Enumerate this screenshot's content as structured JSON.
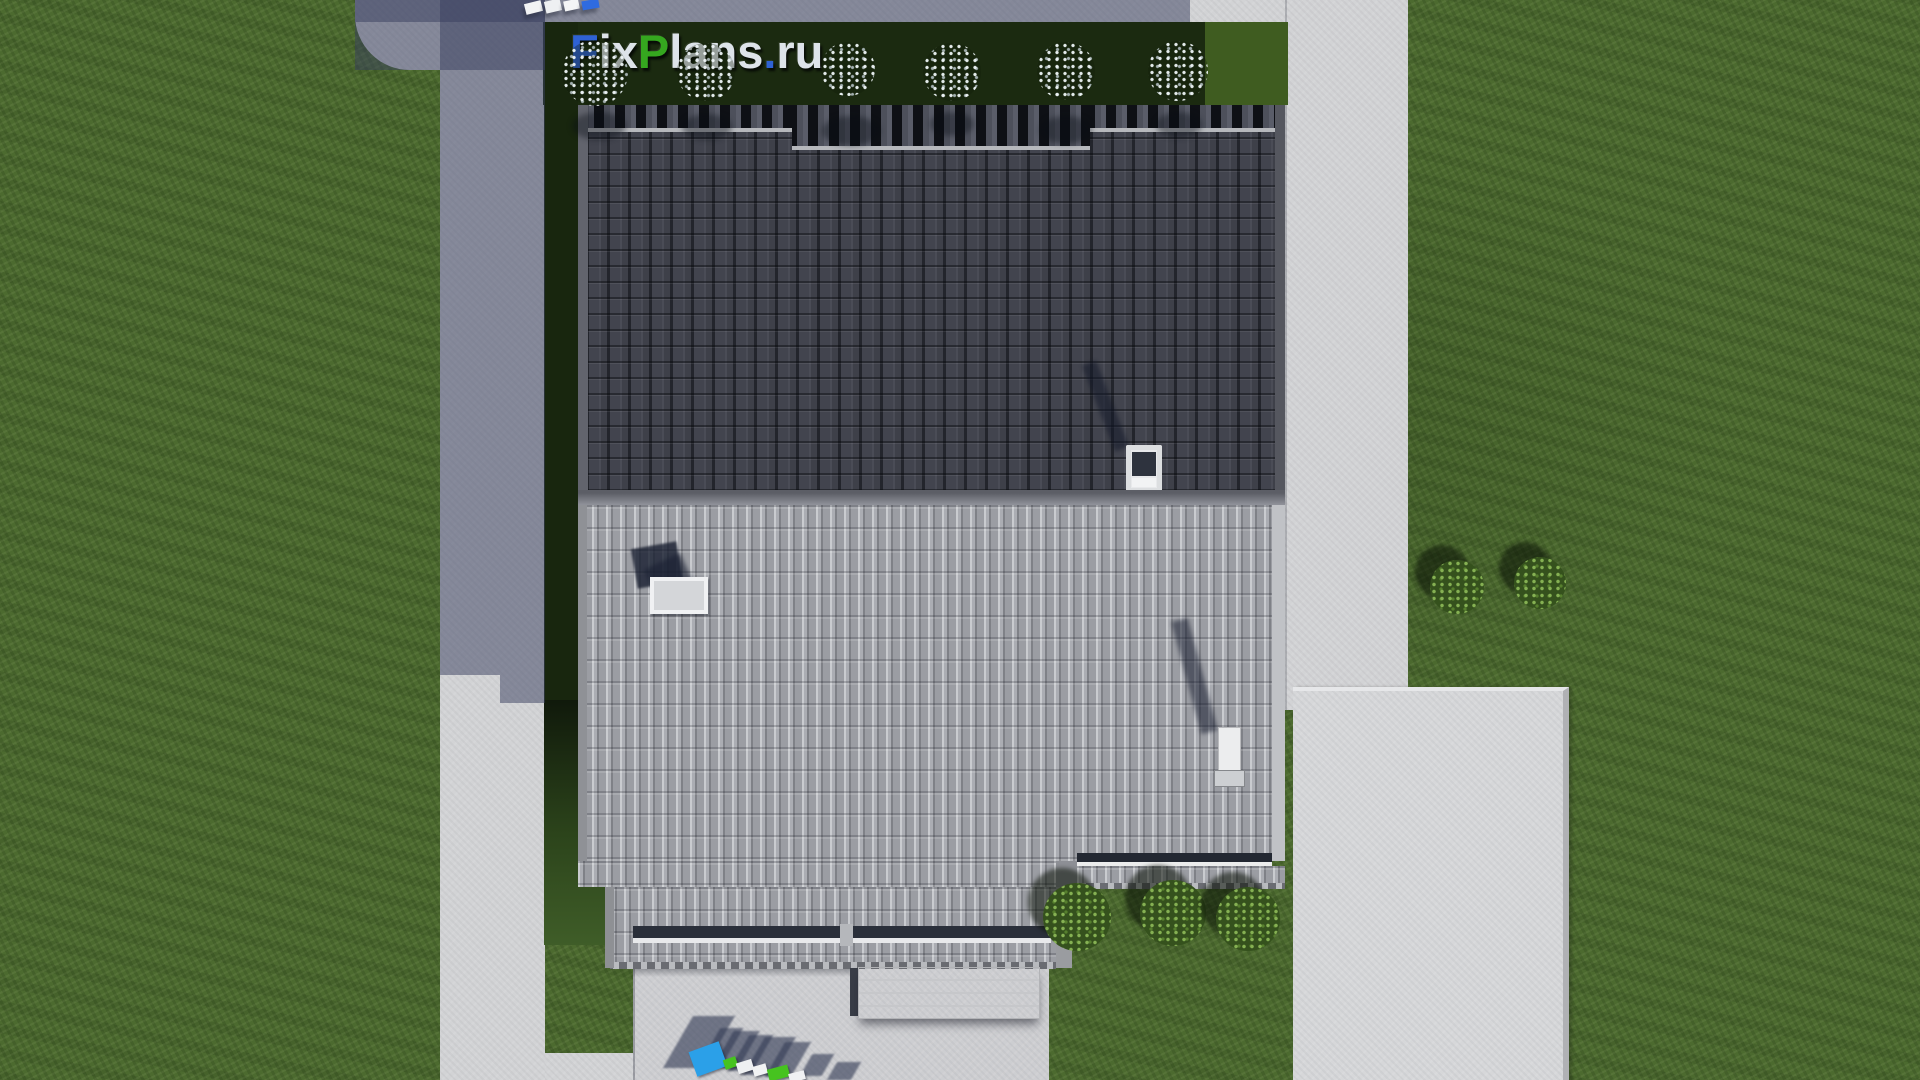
{
  "watermark": {
    "text": "FixPlans.ru",
    "parts": [
      {
        "t": "F",
        "c": "#2f62d4"
      },
      {
        "t": "ix",
        "c": "#dde3e9"
      },
      {
        "t": "P",
        "c": "#35a71f"
      },
      {
        "t": "lans",
        "c": "#dde3e9"
      },
      {
        "t": ".",
        "c": "#2f62d4"
      },
      {
        "t": "ru",
        "c": "#dde3e9"
      }
    ]
  },
  "palette": {
    "lawn": "#4c6a2f",
    "hedge": "#1b2a10",
    "concrete": "#d2d3d5",
    "cast_shadow": "#373e5e",
    "upper_roof": "#3e4049",
    "lower_roof": "#a2a4aa",
    "logo_blue": "#2ba0e8",
    "logo_green": "#46c31f",
    "logo_white": "#f0f1f3"
  },
  "vegetation": {
    "white_flower_bushes": [
      {
        "x": 595,
        "y": 73,
        "r": 33
      },
      {
        "x": 706,
        "y": 72,
        "r": 29
      },
      {
        "x": 848,
        "y": 69,
        "r": 27
      },
      {
        "x": 952,
        "y": 72,
        "r": 29
      },
      {
        "x": 1066,
        "y": 71,
        "r": 29
      },
      {
        "x": 1178,
        "y": 71,
        "r": 30
      }
    ],
    "green_bushes": [
      {
        "x": 1457,
        "y": 587,
        "r": 27
      },
      {
        "x": 1540,
        "y": 583,
        "r": 26
      },
      {
        "x": 1077,
        "y": 917,
        "r": 34
      },
      {
        "x": 1173,
        "y": 913,
        "r": 33
      },
      {
        "x": 1248,
        "y": 919,
        "r": 32
      }
    ],
    "roof_bush_shadows": [
      {
        "x": 572,
        "y": 112,
        "w": 54,
        "h": 28
      },
      {
        "x": 682,
        "y": 114,
        "w": 50,
        "h": 26
      },
      {
        "x": 822,
        "y": 116,
        "w": 58,
        "h": 30
      },
      {
        "x": 930,
        "y": 112,
        "w": 44,
        "h": 24
      },
      {
        "x": 1040,
        "y": 116,
        "w": 52,
        "h": 28
      },
      {
        "x": 1156,
        "y": 112,
        "w": 46,
        "h": 26
      }
    ]
  },
  "ground_logo": {
    "text": "FixPlans",
    "blocks": [
      {
        "x": 692,
        "y": 1046,
        "w": 32,
        "h": 26,
        "rot": -20,
        "c": "#2ba0e8"
      },
      {
        "x": 724,
        "y": 1058,
        "w": 13,
        "h": 10,
        "rot": -19,
        "c": "#46c31f"
      },
      {
        "x": 737,
        "y": 1061,
        "w": 16,
        "h": 11,
        "rot": -17,
        "c": "#eef0f2"
      },
      {
        "x": 753,
        "y": 1065,
        "w": 14,
        "h": 10,
        "rot": -16,
        "c": "#f2f3f4"
      },
      {
        "x": 768,
        "y": 1067,
        "w": 21,
        "h": 12,
        "rot": -15,
        "c": "#46c31f"
      },
      {
        "x": 789,
        "y": 1072,
        "w": 16,
        "h": 9,
        "rot": -14,
        "c": "#f0f1f3"
      }
    ],
    "extra_shadows": [
      {
        "x": 806,
        "y": 1054,
        "w": 22,
        "h": 22
      },
      {
        "x": 832,
        "y": 1062,
        "w": 24,
        "h": 18
      }
    ]
  },
  "top_logo_blocks": [
    {
      "x": 525,
      "y": 2,
      "w": 17,
      "h": 11,
      "rot": -14,
      "c": "#f2f3f4"
    },
    {
      "x": 545,
      "y": 0,
      "w": 16,
      "h": 12,
      "rot": -13,
      "c": "#eef0f2"
    },
    {
      "x": 564,
      "y": 0,
      "w": 15,
      "h": 10,
      "rot": -12,
      "c": "#f4f5f6"
    },
    {
      "x": 582,
      "y": 0,
      "w": 17,
      "h": 9,
      "rot": -10,
      "c": "#2f6be0"
    }
  ]
}
